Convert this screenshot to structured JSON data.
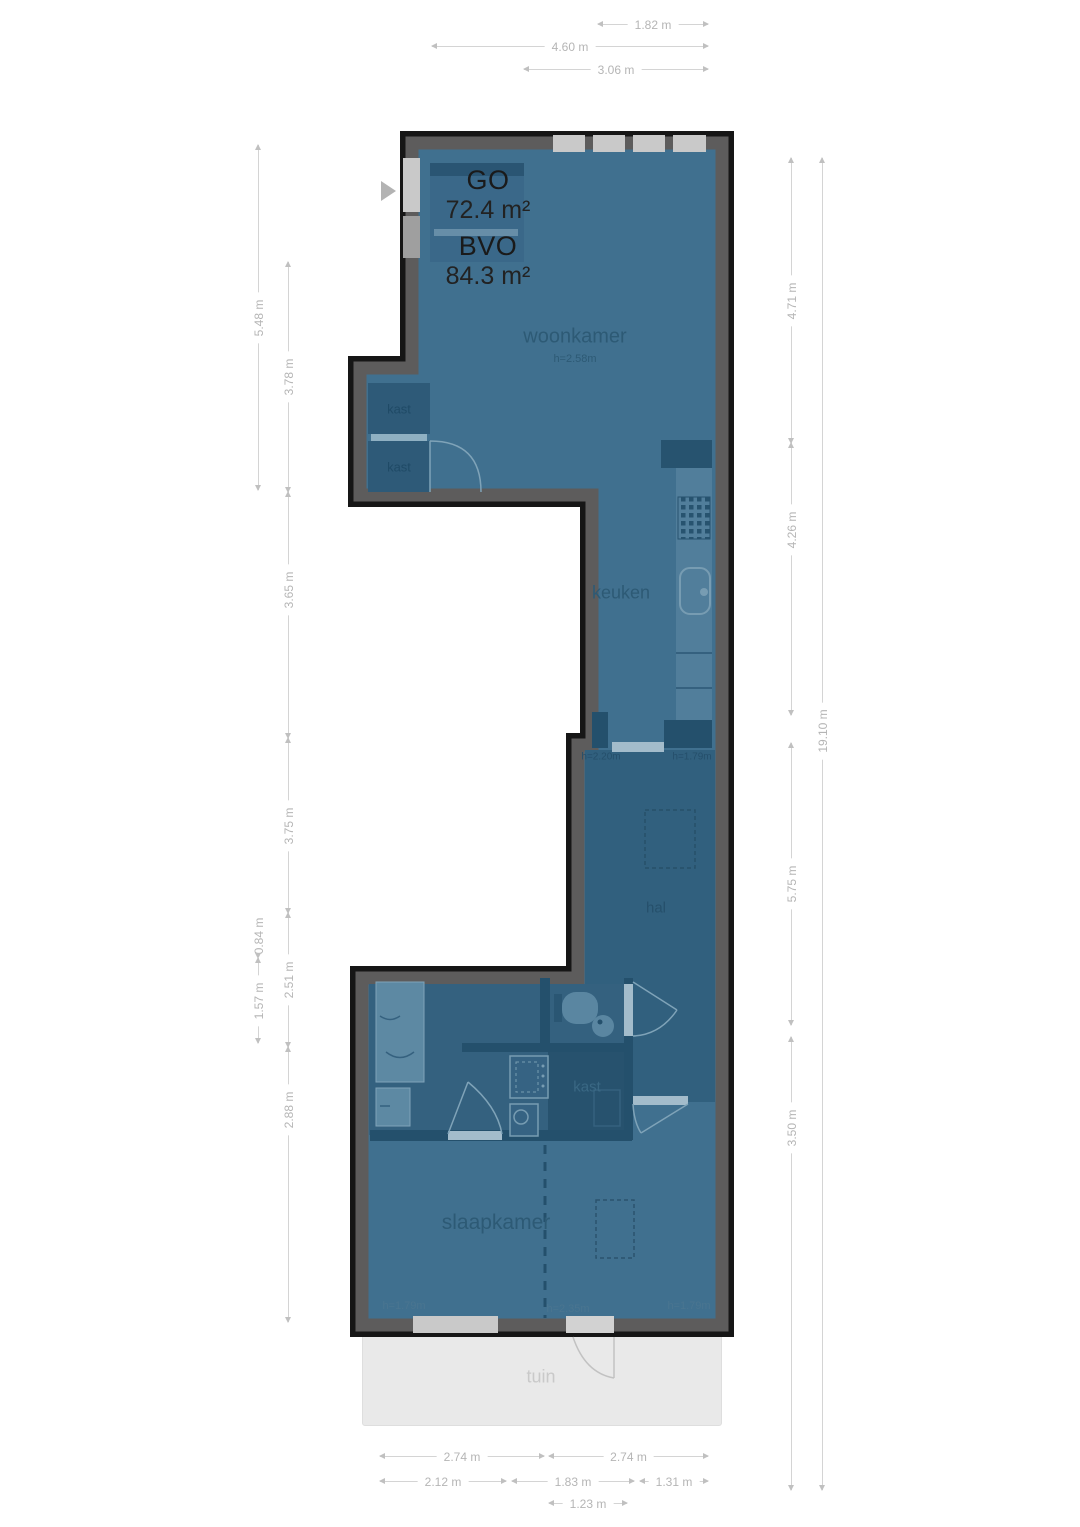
{
  "plan": {
    "area_summary": {
      "go_label": "GO",
      "go_value": "72.4 m²",
      "bvo_label": "BVO",
      "bvo_value": "84.3 m²"
    },
    "rooms": {
      "woonkamer": {
        "name": "woonkamer",
        "ceiling": "h=2.58m"
      },
      "keuken": {
        "name": "keuken"
      },
      "hal": {
        "name": "hal"
      },
      "slaapkamer": {
        "name": "slaapkamer"
      },
      "kast_woonkamer_upper": {
        "name": "kast"
      },
      "kast_woonkamer_lower": {
        "name": "kast"
      },
      "kast_hal": {
        "name": "kast"
      },
      "tuin": {
        "name": "tuin"
      }
    },
    "height_markers": {
      "keuken_left": "h=2.20m",
      "keuken_right": "h=1.79m",
      "slaapkamer_left": "h=1.79m",
      "slaapkamer_mid": "h=2.35m",
      "slaapkamer_right": "h=1.79m"
    }
  },
  "dims": {
    "top": [
      "1.82 m",
      "4.60 m",
      "3.06 m"
    ],
    "bottom": [
      "2.74 m",
      "2.74 m",
      "2.12 m",
      "1.83 m",
      "1.31 m",
      "1.23 m"
    ],
    "left_outer": [
      "5.48 m",
      "0.84 m",
      "1.57 m"
    ],
    "left_inner": [
      "3.78 m",
      "3.65 m",
      "3.75 m",
      "2.51 m",
      "2.88 m"
    ],
    "right_inner": [
      "4.71 m",
      "4.26 m",
      "5.75 m",
      "3.50 m"
    ],
    "right_outer": [
      "19.10 m"
    ]
  },
  "colors": {
    "floor": "#40708f",
    "floor_dark": "#31607e",
    "floor_darker": "#27526e",
    "interior_wall": "#24506c",
    "wall_outline": "#161616",
    "wall_fill": "#5d5c5c",
    "window": "#c9c9c9",
    "fixture_light": "#7fa3b8",
    "counter": "#517e9b",
    "tuin_bg": "#e9e9e9",
    "dim_text": "#b5b5b5",
    "label_text": "#2d5a75",
    "area_text": "#1a1a1a"
  }
}
